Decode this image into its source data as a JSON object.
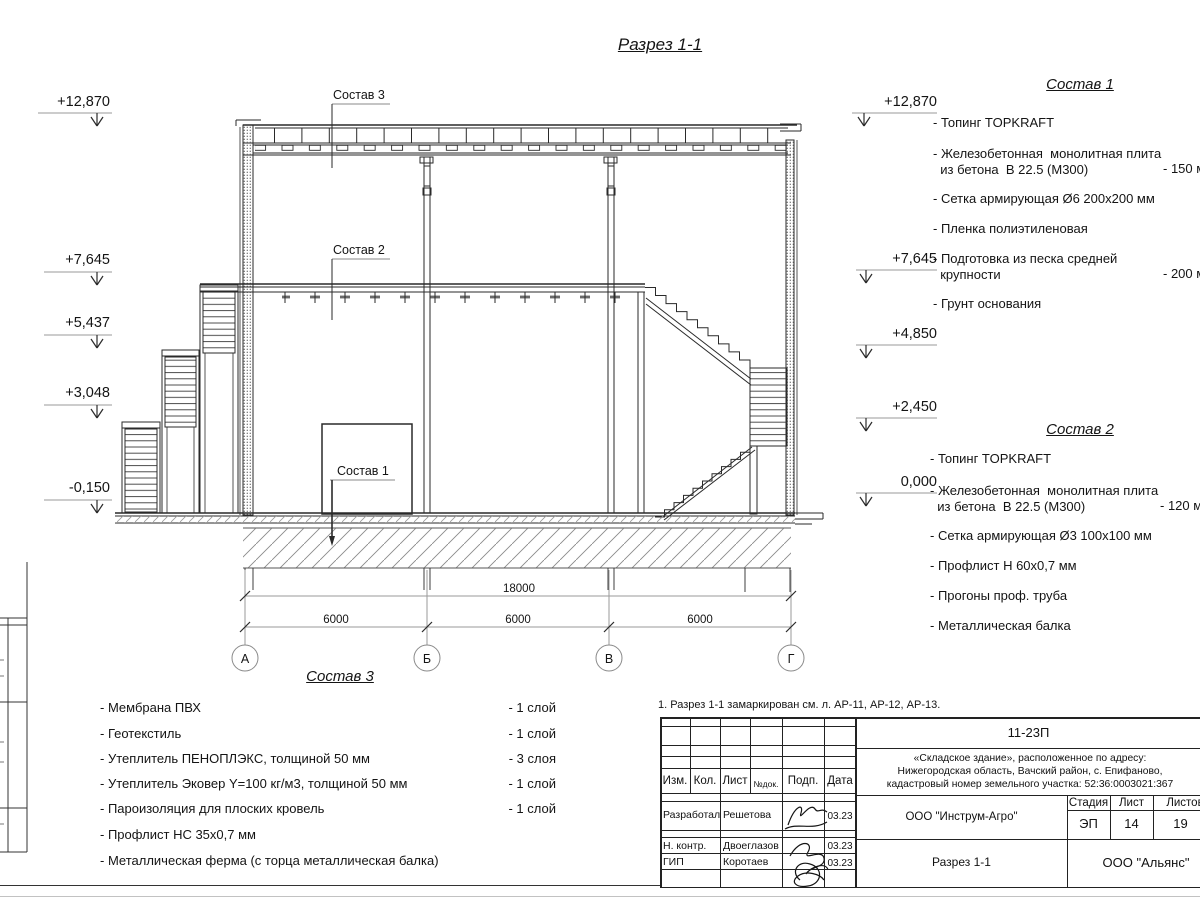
{
  "page": {
    "title": "Разрез 1-1"
  },
  "elevations": {
    "left": [
      "+12,870",
      "+7,645",
      "+5,437",
      "+3,048",
      "-0,150"
    ],
    "right": [
      "+12,870",
      "+7,645",
      "+4,850",
      "+2,450",
      "0,000"
    ]
  },
  "drawing": {
    "axis_labels": [
      "А",
      "Б",
      "В",
      "Г"
    ],
    "dimensions": {
      "total": "18000",
      "segments": [
        "6000",
        "6000",
        "6000"
      ]
    },
    "callouts": [
      "Состав 3",
      "Состав 2",
      "Состав 1"
    ]
  },
  "compositions": [
    {
      "title": "Состав 1",
      "items": [
        {
          "text": "- Топинг TOPKRAFT"
        },
        {
          "text": "- Железобетонная  монолитная плита\n  из бетона  В 22.5 (М300)",
          "note": "- 150 мм"
        },
        {
          "text": "- Сетка армирующая Ø6 200х200 мм"
        },
        {
          "text": "- Пленка полиэтиленовая"
        },
        {
          "text": "- Подготовка из песка средней\n  крупности",
          "note": "- 200 мм"
        },
        {
          "text": "- Грунт основания"
        }
      ]
    },
    {
      "title": "Состав 2",
      "items": [
        {
          "text": "- Топинг TOPKRAFT"
        },
        {
          "text": "- Железобетонная  монолитная плита\n  из бетона  В 22.5 (М300)",
          "note": "- 120 мм"
        },
        {
          "text": "- Сетка армирующая Ø3 100х100 мм"
        },
        {
          "text": "- Профлист Н 60х0,7 мм"
        },
        {
          "text": "- Прогоны проф. труба"
        },
        {
          "text": "- Металлическая балка"
        }
      ]
    },
    {
      "title": "Состав 3",
      "items": [
        {
          "text": "- Мембрана ПВХ",
          "qty": "- 1 слой"
        },
        {
          "text": "- Геотекстиль",
          "qty": "- 1 слой"
        },
        {
          "text": "- Утеплитель ПЕНОПЛЭКС, толщиной 50 мм",
          "qty": "- 3 слоя"
        },
        {
          "text": "- Утеплитель Эковер Y=100 кг/м3, толщиной 50 мм",
          "qty": "- 1 слой"
        },
        {
          "text": "- Пароизоляция для плоских кровель",
          "qty": "- 1 слой"
        },
        {
          "text": "- Профлист НС 35х0,7 мм"
        },
        {
          "text": "- Металлическая ферма (с торца металлическая балка)"
        }
      ]
    }
  ],
  "note": "1. Разрез 1-1 замаркирован см. л. АР-11, АР-12, АР-13.",
  "title_block": {
    "doc_number": "11-23П",
    "project_lines": [
      "«Складское здание», расположенное по адресу:",
      "Нижегородская область, Вачский район, с. Епифаново,",
      "кадастровый номер земельного участка: 52:36:0003021:367"
    ],
    "header_cells": [
      "Изм.",
      "Кол.",
      "Лист",
      "№док.",
      "Подп.",
      "Дата"
    ],
    "rows": [
      {
        "role": "Разработал",
        "name": "Решетова",
        "date": "03.23"
      },
      {
        "role": "Н. контр.",
        "name": "Двоеглазов",
        "date": "03.23"
      },
      {
        "role": "ГИП",
        "name": "Коротаев",
        "date": "03.23"
      }
    ],
    "company": "ООО \"Инструм-Агро\"",
    "sheet_title": "Разрез 1-1",
    "firm": "ООО \"Альянс\"",
    "stage_header": [
      "Стадия",
      "Лист",
      "Листов"
    ],
    "stage_values": [
      "ЭП",
      "14",
      "19"
    ]
  }
}
